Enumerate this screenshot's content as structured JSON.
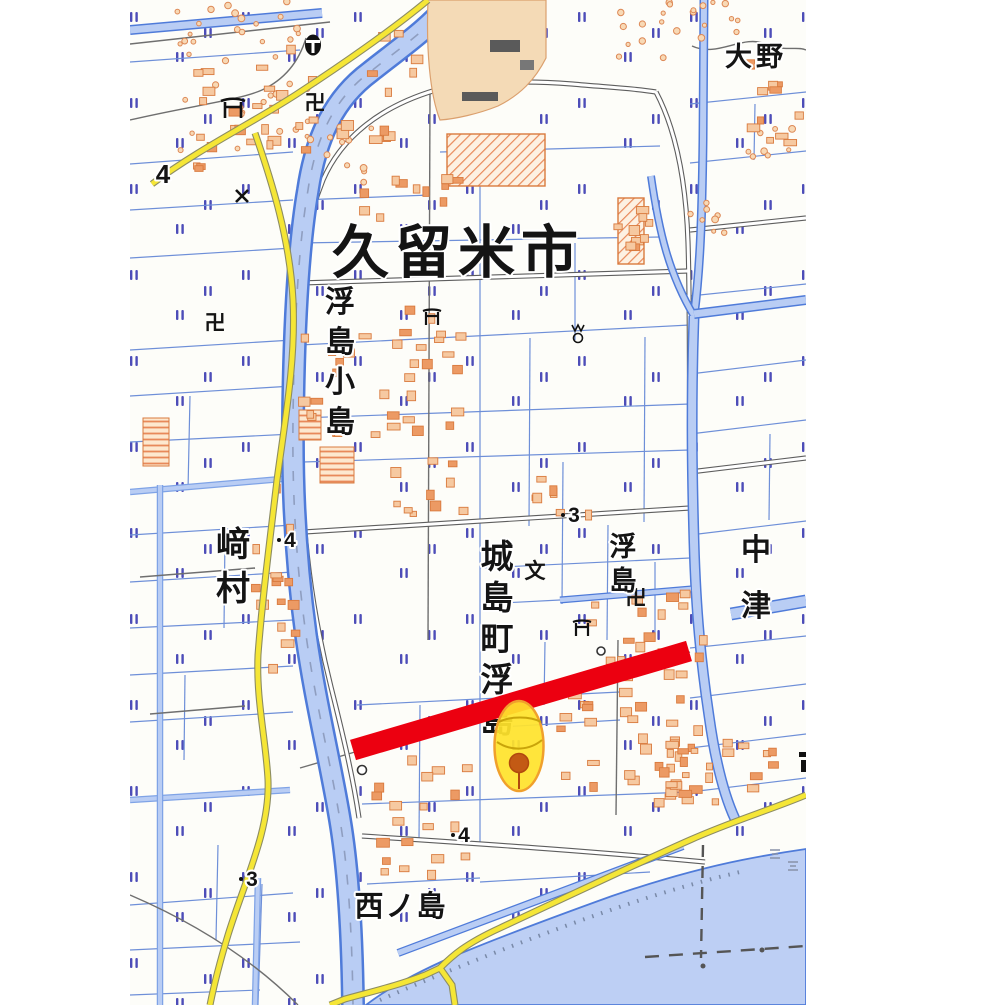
{
  "map": {
    "city_label": {
      "text": "久留米市"
    },
    "place_labels": [
      {
        "text": "大野",
        "orientation": "h"
      },
      {
        "text": "浮島小島",
        "orientation": "v"
      },
      {
        "text": "﨑村",
        "orientation": "v"
      },
      {
        "text": "城島町浮島",
        "orientation": "v"
      },
      {
        "text": "浮島",
        "orientation": "v"
      },
      {
        "text": "中津",
        "orientation": "v"
      },
      {
        "text": "西ノ島",
        "orientation": "h"
      }
    ],
    "spot_elevations": [
      {
        "value": "4",
        "x": 163,
        "y": 182
      },
      {
        "value": "4",
        "x": 289,
        "y": 547
      },
      {
        "value": "3",
        "x": 573,
        "y": 521
      },
      {
        "value": "4",
        "x": 463,
        "y": 841
      },
      {
        "value": "3",
        "x": 251,
        "y": 885
      }
    ],
    "symbols": [
      {
        "name": "town-office-symbol",
        "x": 313,
        "y": 45
      },
      {
        "name": "shrine-torii-symbol",
        "x": 233,
        "y": 108
      },
      {
        "name": "temple-symbol",
        "x": 315,
        "y": 102,
        "glyph": "卍"
      },
      {
        "name": "police-box-symbol",
        "x": 242,
        "y": 196
      },
      {
        "name": "temple-symbol",
        "x": 215,
        "y": 322,
        "glyph": "卍"
      },
      {
        "name": "shrine-torii-symbol",
        "x": 432,
        "y": 318
      },
      {
        "name": "gas-well-symbol",
        "x": 578,
        "y": 330
      },
      {
        "name": "school-symbol",
        "x": 535,
        "y": 570,
        "glyph": "文"
      },
      {
        "name": "shrine-torii-symbol",
        "x": 582,
        "y": 629
      },
      {
        "name": "temple-symbol",
        "x": 636,
        "y": 597,
        "glyph": "卍"
      },
      {
        "name": "well-symbol",
        "x": 601,
        "y": 651
      },
      {
        "name": "well-symbol",
        "x": 362,
        "y": 770
      }
    ],
    "annotations": {
      "highlight_line": {
        "color": "#ec0010",
        "from": {
          "x": 353,
          "y": 750
        },
        "to": {
          "x": 689,
          "y": 651
        },
        "width": 21
      },
      "marker": {
        "fill": "#ffe32c",
        "border": "#f0a02c",
        "cx": 519,
        "cy": 746,
        "rx": 24.5,
        "ry": 45,
        "dot_color": "#c35a14"
      }
    },
    "building_clusters": [
      {
        "x": 190,
        "y": 28,
        "w": 125,
        "h": 145,
        "n": 26
      },
      {
        "x": 333,
        "y": 28,
        "w": 80,
        "h": 115,
        "n": 13
      },
      {
        "x": 352,
        "y": 172,
        "w": 105,
        "h": 42,
        "n": 11
      },
      {
        "x": 292,
        "y": 330,
        "w": 165,
        "h": 108,
        "n": 26
      },
      {
        "x": 385,
        "y": 440,
        "w": 75,
        "h": 85,
        "n": 10
      },
      {
        "x": 250,
        "y": 470,
        "w": 48,
        "h": 195,
        "n": 15
      },
      {
        "x": 395,
        "y": 300,
        "w": 60,
        "h": 120,
        "n": 10
      },
      {
        "x": 553,
        "y": 575,
        "w": 148,
        "h": 225,
        "n": 52
      },
      {
        "x": 658,
        "y": 738,
        "w": 118,
        "h": 68,
        "n": 24
      },
      {
        "x": 368,
        "y": 742,
        "w": 95,
        "h": 130,
        "n": 20
      },
      {
        "x": 742,
        "y": 52,
        "w": 62,
        "h": 88,
        "n": 11
      },
      {
        "x": 598,
        "y": 200,
        "w": 58,
        "h": 68,
        "n": 9
      },
      {
        "x": 532,
        "y": 476,
        "w": 62,
        "h": 40,
        "n": 7
      }
    ],
    "vegetation_clusters": [
      {
        "x": 175,
        "y": 0,
        "w": 135,
        "h": 165,
        "n": 38
      },
      {
        "x": 305,
        "y": 118,
        "w": 70,
        "h": 70,
        "n": 12
      },
      {
        "x": 618,
        "y": 0,
        "w": 125,
        "h": 58,
        "n": 22
      },
      {
        "x": 688,
        "y": 175,
        "w": 45,
        "h": 60,
        "n": 8
      },
      {
        "x": 745,
        "y": 118,
        "w": 50,
        "h": 40,
        "n": 8
      }
    ],
    "colors": {
      "water": "#bdcff4",
      "water_edge": "#4f7bd9",
      "parcel_line": "#6e8fd8",
      "paddy_symbol": "#4d4db8",
      "road_yellow": "#f5e636",
      "road_gray": "#5e5e5e",
      "building_outline": "#d97a3e",
      "building_fill": "#f6c9a1",
      "built_up_area": "#f4dab6",
      "highlight_red": "#ec0010",
      "marker_yellow": "#ffe32c"
    }
  }
}
